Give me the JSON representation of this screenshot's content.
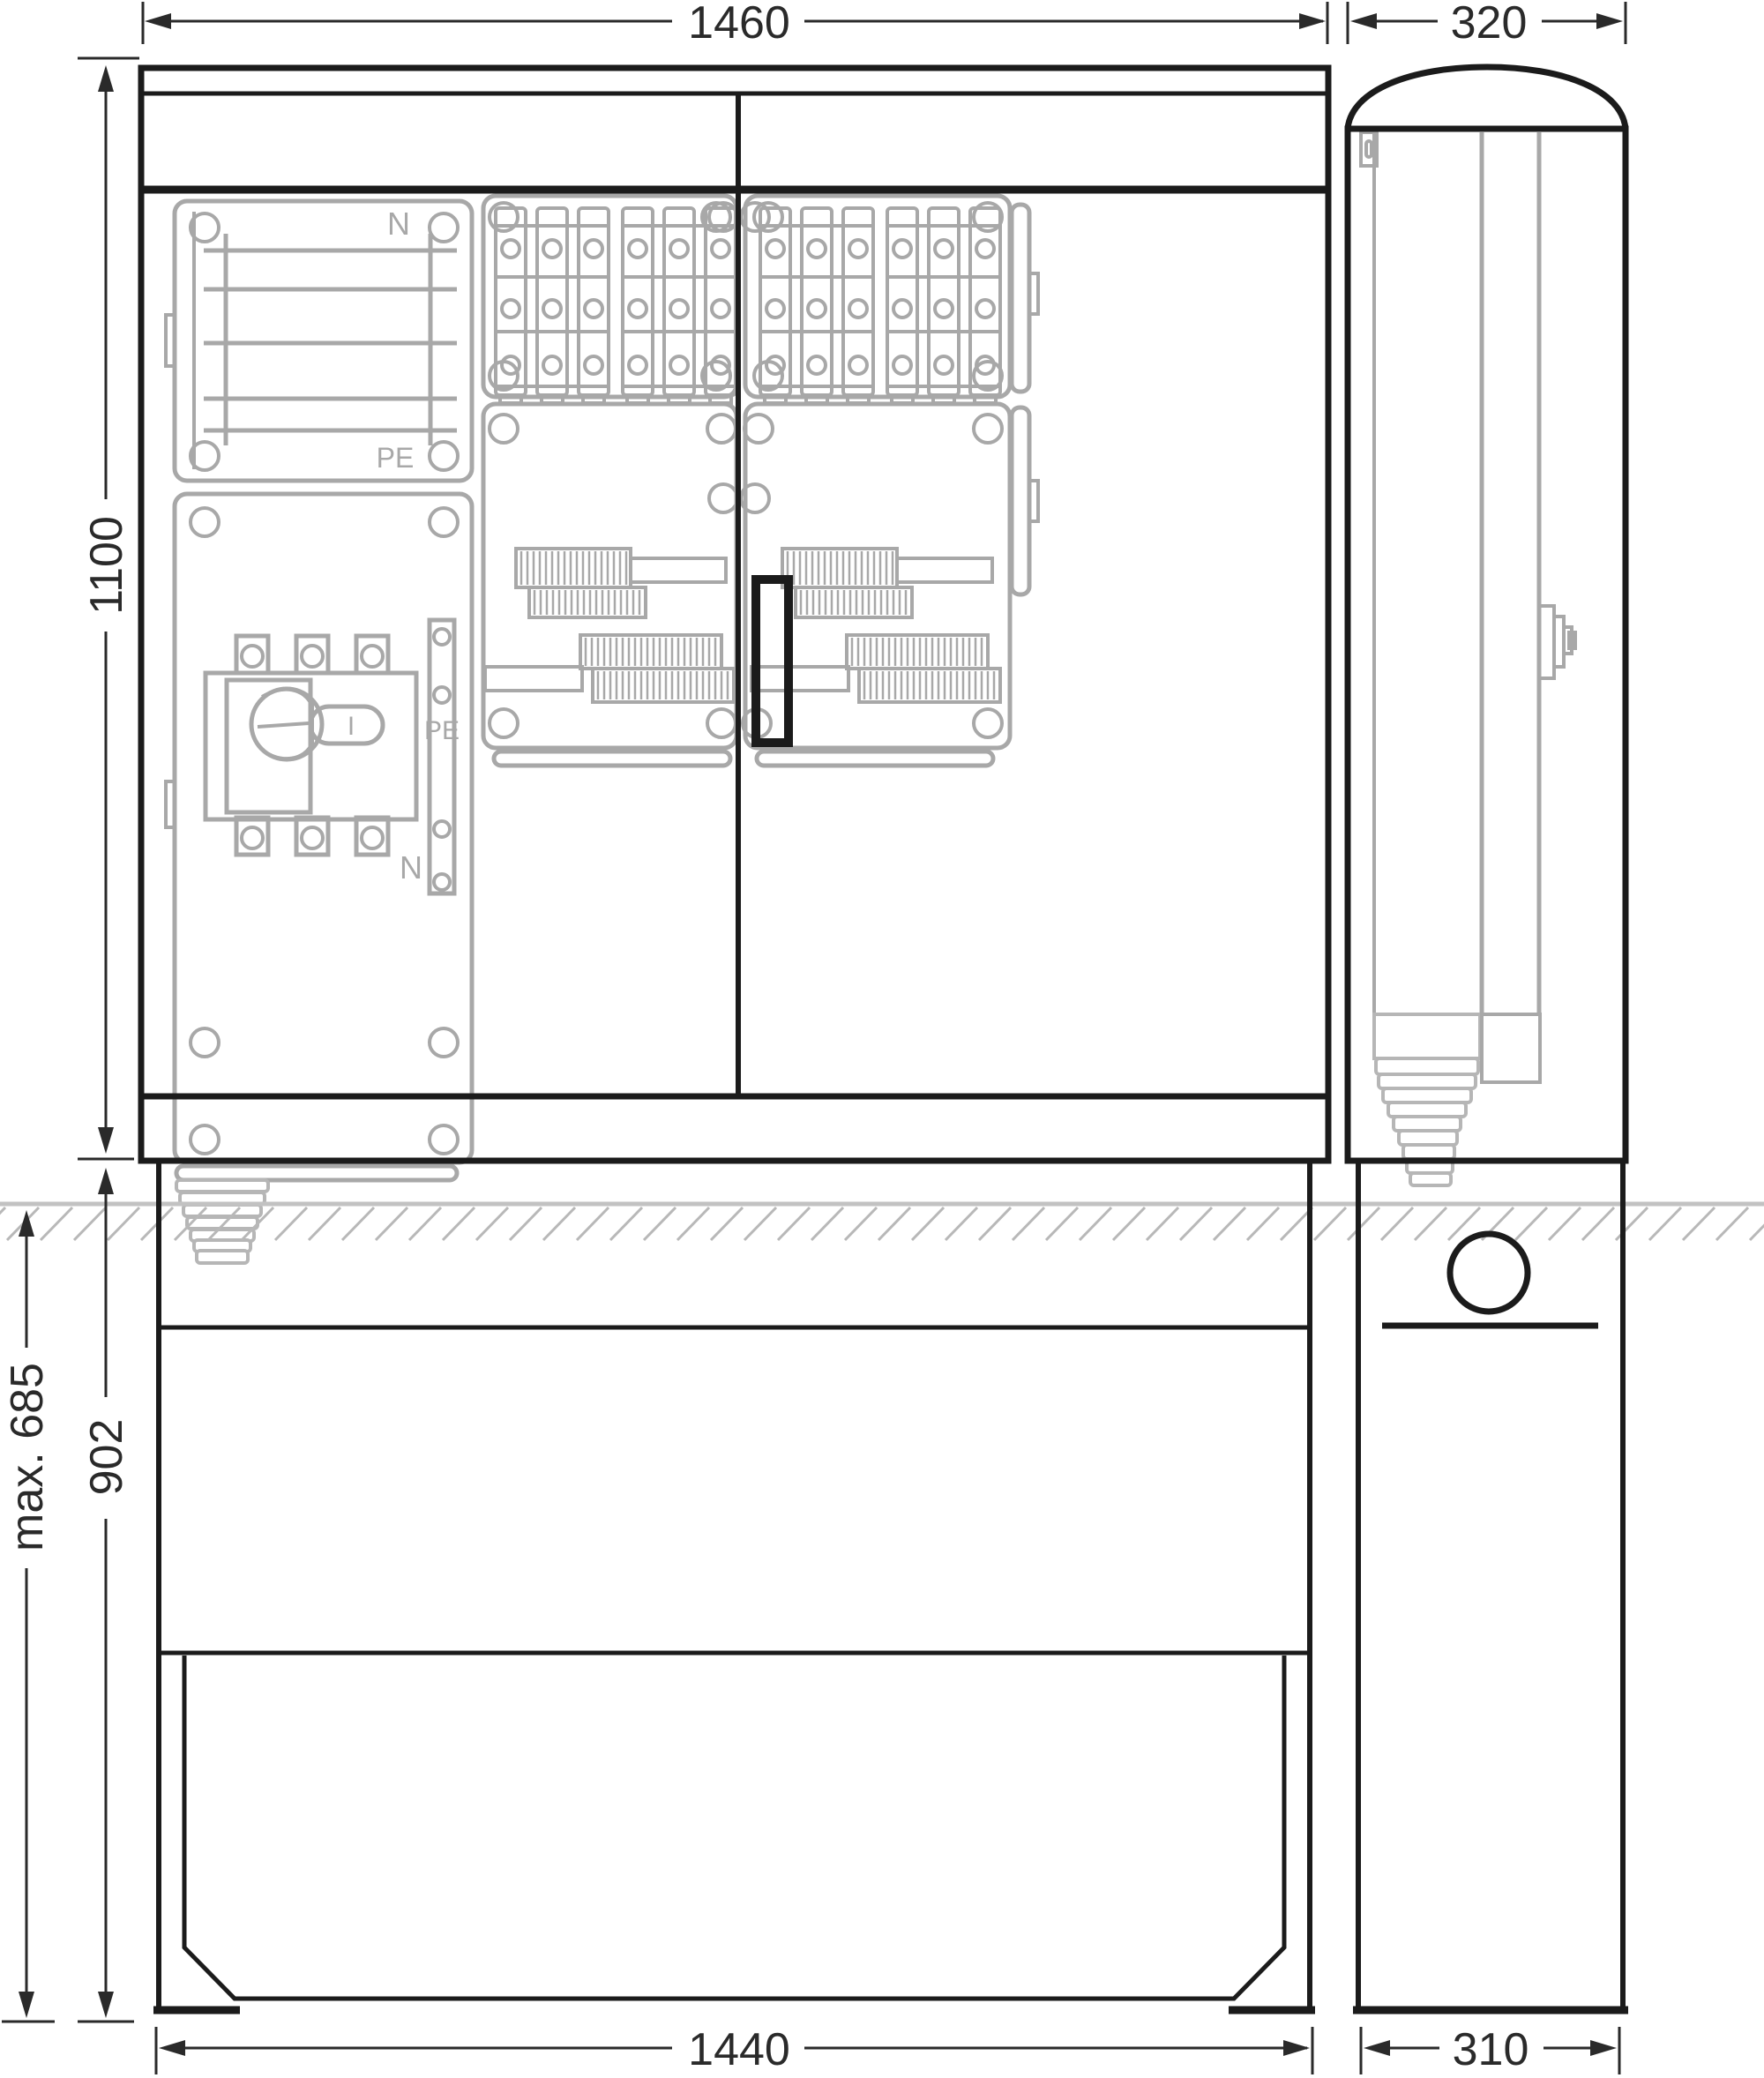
{
  "drawing": {
    "type": "cabinet-dimension-drawing",
    "views": [
      "front",
      "side"
    ]
  },
  "dimensions": {
    "front_width": "1460",
    "front_height": "1100",
    "side_width": "320",
    "base_depth_max": "max. 685",
    "base_height": "902",
    "base_width": "1440",
    "side_base_width": "310"
  },
  "labels": {
    "busbar_n": "N",
    "busbar_pe": "PE",
    "switch_rail_pe": "PE",
    "switch_rail_n": "N",
    "switch_position": "I"
  },
  "colors": {
    "outline": "#1b1b1b",
    "dimension": "#2a2a2a",
    "ghost": "#a8a8a8",
    "ground": "#b8b8b8"
  }
}
